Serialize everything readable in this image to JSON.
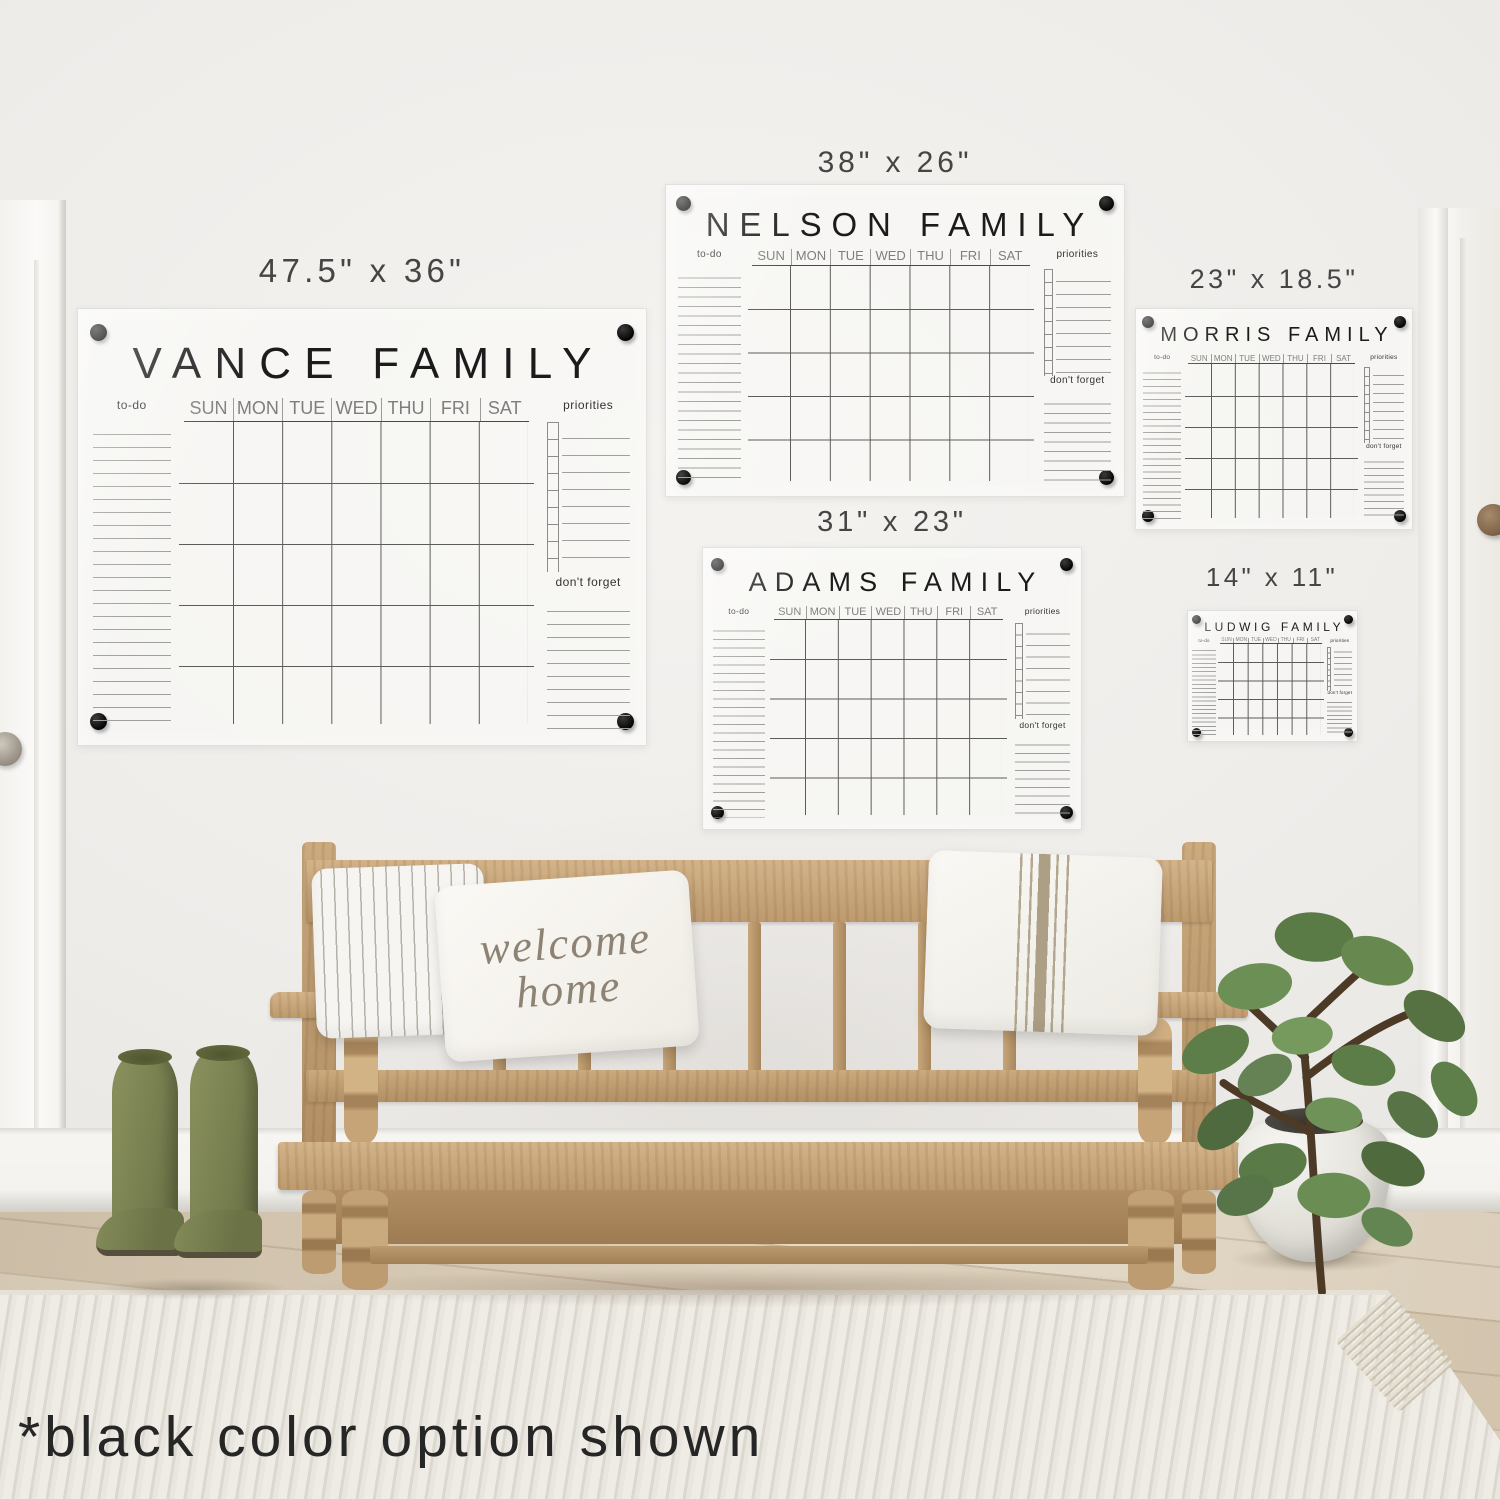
{
  "scene": {
    "caption": "*black color option shown",
    "pillow": {
      "line1": "welcome",
      "line2": "home"
    }
  },
  "days": [
    "SUN",
    "MON",
    "TUE",
    "WED",
    "THU",
    "FRI",
    "SAT"
  ],
  "labels": {
    "todo": "to-do",
    "priorities": "priorities",
    "dont_forget": "don't forget"
  },
  "calendars": [
    {
      "id": "vance",
      "title": "VANCE FAMILY",
      "size": "47.5\" x 36\""
    },
    {
      "id": "nelson",
      "title": "NELSON FAMILY",
      "size": "38\" x 26\""
    },
    {
      "id": "adams",
      "title": "ADAMS FAMILY",
      "size": "31\" x 23\""
    },
    {
      "id": "morris",
      "title": "MORRIS FAMILY",
      "size": "23\" x 18.5\""
    },
    {
      "id": "ludwig",
      "title": "LUDWIG FAMILY",
      "size": "14\" x 11\""
    }
  ],
  "palette": {
    "marker_text": "#1b1b1b",
    "hardware_black": "#0a0a0a",
    "wall": "#f1efec",
    "bench_wood": "#c2a177",
    "floor_wood": "#d8ccb7",
    "boots_green": "#7c8454",
    "plant_green": "#5d7c48",
    "rug_cream": "#e9e6df"
  }
}
